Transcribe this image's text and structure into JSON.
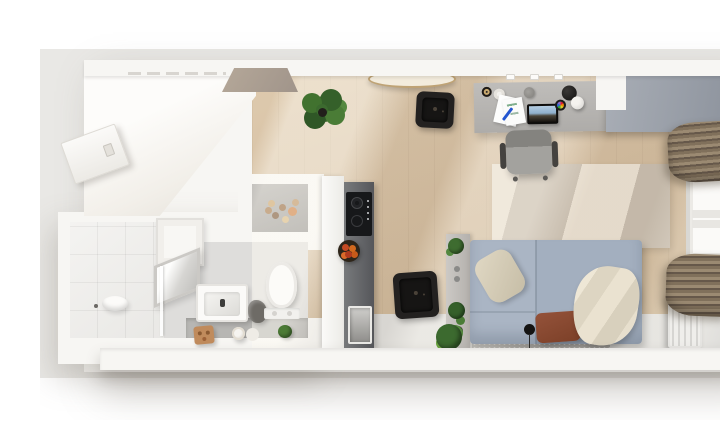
{
  "scene": {
    "type": "Top-down 3D rendered floor plan of a studio apartment",
    "rooms": [
      {
        "name": "entry",
        "items": [
          "entrance-door"
        ]
      },
      {
        "name": "bathroom",
        "items": [
          "walk-in-shower",
          "shower-bowl",
          "floor-drain",
          "wall-cabinet",
          "leaning-mirror",
          "washbasin",
          "dark-towel",
          "toilet",
          "vanity-counter",
          "wooden-cube-stool",
          "rolled-towels",
          "potted-plant",
          "spice-shelf-with-jars",
          "glass-partition"
        ]
      },
      {
        "name": "kitchen",
        "items": [
          "upper-cabinet-row",
          "extractor-panel",
          "tall-unit",
          "counter-strip",
          "induction-cooktop",
          "fruit-bowl",
          "kitchen-sink",
          "round-dining-table",
          "black-dining-stool",
          "large-potted-plant"
        ]
      },
      {
        "name": "living-sleeping-area",
        "items": [
          "desk",
          "monitor",
          "papers-and-pen",
          "pen-cup",
          "mug",
          "speaker",
          "color-wheel",
          "two-ball-desk-lamp",
          "wall-sockets",
          "office-chair",
          "wardrobe",
          "window",
          "curtain-top",
          "curtain-bottom",
          "radiator",
          "striped-area-rug",
          "double-bed",
          "headboard-shelf-with-plants",
          "beige-pillow",
          "rust-pillow",
          "cream-throw-blanket",
          "bedside-rug",
          "reading-lamp",
          "black-side-stool",
          "floor-plant"
        ]
      }
    ]
  },
  "palette": {
    "page-bg": "#ffffff",
    "mat": "#e9e8e5",
    "wall": "#f7f6f3",
    "wood": "#d5bfa2",
    "wood-light": "#eadbc2",
    "entry-floor": "#fbfaf7",
    "bath-floor": "#dedddb",
    "shower-floor": "#f0efed",
    "vanity": "#b7b6b3",
    "nook-floor": "#a5a3a0",
    "counter-dark": "#636466",
    "cooktop": "#17181a",
    "fruit": "#c44a23",
    "desk": "#b8b6b3",
    "chair": "#989793",
    "wardrobe": "#99a0aa",
    "curtain": "#8b7b66",
    "curtain-dark": "#6a5c49",
    "window-frame": "#f1f0ed",
    "radiator": "#e9e8e5",
    "rug-cream": "#eae0d1",
    "rug-taupe": "#c9bdae",
    "walkway": "#e0dfdc",
    "bed": "#a6b2c1",
    "pillow-beige": "#d8cfba",
    "pillow-rust": "#8a4a30",
    "blanket": "#e5decd",
    "bed-rug": "#b2b0ac",
    "plant": "#3e6c30",
    "stool": "#232120",
    "screen-sky": "#aac6e0",
    "pen-blue": "#2456d0"
  }
}
